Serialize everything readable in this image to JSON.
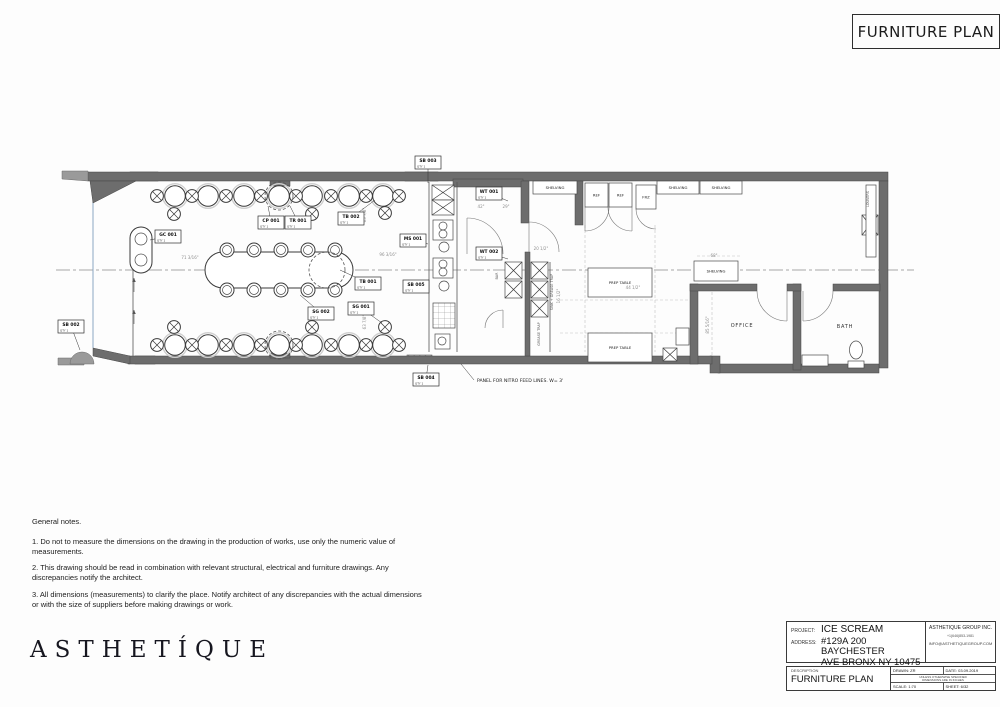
{
  "sheet_title": "FURNITURE PLAN",
  "logo_text": "ASTHETÍQUE",
  "notes": {
    "heading": "General notes.",
    "items": [
      "1. Do not to measure the dimensions on the drawing in the production of works, use only the numeric value of measurements.",
      "2. This drawing should be read in combination with relevant structural, electrical and furniture drawings. Any discrepancies notify the architect.",
      "3. All dimensions (measurements) to clarify the place. Notify architect of any discrepancies with the actual dimensions or with the size of suppliers before making drawings or work."
    ]
  },
  "title_block": {
    "project_label": "PROJECT:",
    "project": "ICE SCREAM",
    "address_label": "ADDRESS:",
    "address_line1": "#129A 200 BAYCHESTER",
    "address_line2": "AVE BRONX NY 10475",
    "company": "ASTHETIQUE GROUP INC.",
    "phone": "+1(646)853-1981",
    "email": "INFO@ASTHETIQUEGROUP.COM",
    "description_label": "DESCRIPTION",
    "description": "FURNITURE PLAN",
    "drawn": "DRAWN: ZR",
    "date": "DATE: 03.09.2019",
    "disclaimer_line1": "UNLESS OTHERWISE SPECIFIED",
    "disclaimer_line2": "DIMENSIONS ARE IN INCHES",
    "scale": "SCALE: 1:70",
    "sheet": "SHEET: 6/32"
  },
  "plan": {
    "centerline": [
      56,
      270,
      914,
      270
    ],
    "walls": [
      [
        88,
        172,
        800,
        9
      ],
      [
        879,
        181,
        9,
        187
      ],
      [
        718,
        364,
        161,
        9
      ],
      [
        710,
        356,
        10,
        17
      ],
      [
        128,
        356,
        584,
        8
      ],
      [
        453,
        179,
        70,
        8
      ],
      [
        521,
        181,
        8,
        42
      ],
      [
        575,
        181,
        8,
        44
      ],
      [
        690,
        284,
        8,
        80
      ],
      [
        793,
        284,
        8,
        86
      ],
      [
        690,
        284,
        67,
        7
      ],
      [
        787,
        284,
        14,
        7
      ],
      [
        833,
        284,
        47,
        7
      ],
      [
        270,
        181,
        20,
        5
      ],
      [
        270,
        353,
        20,
        5
      ],
      [
        525,
        252,
        5,
        104
      ]
    ],
    "hatch": [
      [
        130,
        172,
        28,
        9
      ],
      [
        405,
        172,
        33,
        9
      ],
      [
        135,
        356,
        20,
        8
      ],
      [
        407,
        355,
        25,
        8
      ],
      [
        692,
        285,
        36,
        5
      ],
      [
        691,
        300,
        6,
        36
      ]
    ],
    "polys": [
      {
        "pts": "90,181 136,181 93,203",
        "cls": "wall"
      },
      {
        "pts": "93,348 130,356 130,364 93,356",
        "cls": "wall"
      },
      {
        "pts": "62,171 88,171 88,181 62,179",
        "cls": "lite"
      },
      {
        "pts": "58,358 84,358 84,365 58,365",
        "cls": "lite"
      }
    ],
    "paths": [
      {
        "d": "M70,364 A12,12 0 0 1 94,364 Z",
        "cls": "lite"
      },
      {
        "d": "M529,222 A30,30 0 0 1 559,252",
        "cls": "arc"
      },
      {
        "d": "M529,222 L529,252",
        "cls": "arc"
      },
      {
        "d": "M467,218 A36,36 0 0 1 503,254",
        "cls": "arc"
      },
      {
        "d": "M467,218 L467,254",
        "cls": "arc"
      },
      {
        "d": "M485,328 A18,18 0 0 1 503,310",
        "cls": "arc"
      },
      {
        "d": "M503,310 L503,328",
        "cls": "arc"
      },
      {
        "d": "M757,291 A30,30 0 0 0 787,321",
        "cls": "arc"
      },
      {
        "d": "M787,291 L787,321",
        "cls": "arc"
      },
      {
        "d": "M833,291 A30,30 0 0 1 803,321",
        "cls": "arc"
      },
      {
        "d": "M803,291 L803,321",
        "cls": "arc"
      },
      {
        "d": "M609,207 A24,24 0 0 1 585,231",
        "cls": "arc"
      },
      {
        "d": "M585,207 L585,231",
        "cls": "arc"
      },
      {
        "d": "M608,207 A24,24 0 0 0 632,231",
        "cls": "arc"
      },
      {
        "d": "M632,207 L632,231",
        "cls": "arc"
      },
      {
        "d": "M636,209 A20,20 0 0 0 656,229",
        "cls": "arc"
      }
    ],
    "glass": [
      [
        93,
        181,
        93,
        348
      ]
    ],
    "lines": [
      [
        133,
        268,
        133,
        356
      ],
      [
        457,
        182,
        457,
        352
      ],
      [
        429,
        182,
        429,
        352
      ],
      [
        550,
        262,
        550,
        352
      ]
    ],
    "dashes": [
      [
        585,
        225,
        585,
        352
      ],
      [
        655,
        225,
        655,
        352
      ],
      [
        560,
        300,
        688,
        300
      ],
      [
        560,
        333,
        688,
        333
      ],
      [
        697,
        256,
        740,
        256
      ],
      [
        712,
        292,
        712,
        360
      ]
    ],
    "tables_top_y": 196,
    "tables_bottom_y": 345,
    "tables_x": [
      175,
      208,
      244,
      279,
      312,
      349,
      383
    ],
    "chairs": [
      [
        157,
        196
      ],
      [
        192,
        196
      ],
      [
        226,
        196
      ],
      [
        261,
        196
      ],
      [
        296,
        196
      ],
      [
        331,
        196
      ],
      [
        366,
        196
      ],
      [
        399,
        196
      ],
      [
        174,
        214
      ],
      [
        312,
        214
      ],
      [
        385,
        213
      ],
      [
        157,
        345
      ],
      [
        192,
        345
      ],
      [
        226,
        345
      ],
      [
        261,
        345
      ],
      [
        296,
        345
      ],
      [
        331,
        345
      ],
      [
        366,
        345
      ],
      [
        399,
        345
      ],
      [
        174,
        327
      ],
      [
        312,
        327
      ],
      [
        385,
        327
      ]
    ],
    "stools": [
      [
        227,
        250
      ],
      [
        254,
        250
      ],
      [
        281,
        250
      ],
      [
        308,
        250
      ],
      [
        335,
        250
      ],
      [
        227,
        290
      ],
      [
        254,
        290
      ],
      [
        281,
        290
      ],
      [
        308,
        290
      ],
      [
        335,
        290
      ]
    ],
    "rings": [
      [
        279,
        196,
        14
      ],
      [
        279,
        345,
        14
      ],
      [
        327,
        270,
        18
      ]
    ],
    "oval": {
      "x": 205,
      "y": 252,
      "w": 148,
      "h": 36,
      "rx": 18
    },
    "pill": {
      "x": 130,
      "y": 227,
      "w": 22,
      "h": 46,
      "rx": 11,
      "c1": [
        141,
        239
      ],
      "c2": [
        141,
        260
      ],
      "r": 6
    },
    "xboxes": [
      [
        432,
        185,
        22,
        15
      ],
      [
        432,
        200,
        22,
        15
      ],
      [
        531,
        262,
        17,
        17
      ],
      [
        531,
        281,
        17,
        17
      ],
      [
        531,
        300,
        17,
        17
      ],
      [
        505,
        262,
        17,
        17
      ],
      [
        505,
        281,
        17,
        17
      ],
      [
        862,
        215,
        16,
        20
      ],
      [
        663,
        348,
        14,
        13
      ]
    ],
    "equip_rects": [
      [
        433,
        220,
        20,
        20
      ],
      [
        433,
        258,
        20,
        20
      ],
      [
        435,
        334,
        15,
        15
      ]
    ],
    "equip_circles": [
      [
        443,
        226,
        4
      ],
      [
        443,
        234,
        4
      ],
      [
        443,
        264,
        4
      ],
      [
        443,
        272,
        4
      ],
      [
        444,
        247,
        5
      ],
      [
        444,
        286,
        5
      ],
      [
        442,
        341,
        4
      ],
      [
        815,
        360,
        3.5
      ]
    ],
    "gridbox": [
      433,
      303,
      22,
      25
    ],
    "boxes": [
      {
        "x": 533,
        "y": 181,
        "w": 44,
        "h": 13,
        "t": "SHELVING"
      },
      {
        "x": 657,
        "y": 181,
        "w": 42,
        "h": 13,
        "t": "SHELVING"
      },
      {
        "x": 700,
        "y": 181,
        "w": 42,
        "h": 13,
        "t": "SHELVING"
      },
      {
        "x": 694,
        "y": 261,
        "w": 44,
        "h": 20,
        "t": "SHELVING"
      },
      {
        "x": 585,
        "y": 183,
        "w": 23,
        "h": 24,
        "t": "REF"
      },
      {
        "x": 609,
        "y": 183,
        "w": 23,
        "h": 24,
        "t": "REF"
      },
      {
        "x": 636,
        "y": 185,
        "w": 20,
        "h": 24,
        "t": "FRZ"
      },
      {
        "x": 588,
        "y": 268,
        "w": 64,
        "h": 29,
        "t": "PREP TABLE"
      },
      {
        "x": 588,
        "y": 333,
        "w": 64,
        "h": 29,
        "t": "PREP TABLE"
      },
      {
        "x": 866,
        "y": 185,
        "w": 10,
        "h": 72,
        "t": ""
      },
      {
        "x": 676,
        "y": 328,
        "w": 13,
        "h": 17,
        "t": ""
      },
      {
        "x": 802,
        "y": 355,
        "w": 26,
        "h": 11,
        "t": ""
      }
    ],
    "toilet": {
      "cx": 856,
      "cy": 350,
      "rx": 6.5,
      "ry": 9,
      "tank": [
        848,
        361,
        16,
        7
      ]
    },
    "tags": [
      {
        "c": "SB 003",
        "q": "QTY 1",
        "x": 415,
        "y": 156,
        "tx": 428,
        "ty": 183
      },
      {
        "c": "WT 001",
        "q": "QTY 1",
        "x": 476,
        "y": 187,
        "tx": 508,
        "ty": 201
      },
      {
        "c": "MS 001",
        "q": "QTY 1",
        "x": 400,
        "y": 234,
        "tx": 428,
        "ty": 244
      },
      {
        "c": "WT 002",
        "q": "QTY 1",
        "x": 476,
        "y": 247,
        "tx": 508,
        "ty": 259
      },
      {
        "c": "SB 005",
        "q": "QTY 1",
        "x": 403,
        "y": 280,
        "tx": 428,
        "ty": 289
      },
      {
        "c": "SB 004",
        "q": "QTY 1",
        "x": 413,
        "y": 373,
        "tx": 428,
        "ty": 365
      },
      {
        "c": "SB 002",
        "q": "QTY 1",
        "x": 58,
        "y": 320,
        "tx": 80,
        "ty": 350
      },
      {
        "c": "GC 001",
        "q": "QTY 1",
        "x": 155,
        "y": 230,
        "tx": 150,
        "ty": 240
      },
      {
        "c": "CP 001",
        "q": "QTY 1",
        "x": 258,
        "y": 216,
        "tx": 268,
        "ty": 206
      },
      {
        "c": "TR 001",
        "q": "QTY 1",
        "x": 285,
        "y": 216,
        "tx": 290,
        "ty": 206
      },
      {
        "c": "TB 002",
        "q": "QTY 1",
        "x": 338,
        "y": 212,
        "tx": 375,
        "ty": 200
      },
      {
        "c": "TB 001",
        "q": "QTY 1",
        "x": 355,
        "y": 277,
        "tx": 340,
        "ty": 270
      },
      {
        "c": "SG 002",
        "q": "QTY 1",
        "x": 308,
        "y": 307,
        "tx": 300,
        "ty": 295
      },
      {
        "c": "SG 001",
        "q": "QTY 1",
        "x": 348,
        "y": 302,
        "tx": 382,
        "ty": 323
      }
    ],
    "rooms": [
      {
        "t": "OFFICE",
        "x": 742,
        "y": 327
      },
      {
        "t": "BATH",
        "x": 845,
        "y": 328
      }
    ],
    "vtexts": [
      {
        "t": "SINK + GREASE TRAP",
        "x": 553,
        "y": 292
      },
      {
        "t": "GREASE TRAP",
        "x": 540,
        "y": 334
      },
      {
        "t": "BAR",
        "x": 498,
        "y": 276
      },
      {
        "t": "LOUVERS",
        "x": 869,
        "y": 199
      }
    ],
    "dims": [
      {
        "t": "71 3/16\"",
        "x": 190,
        "y": 259
      },
      {
        "t": "96 3/16\"",
        "x": 388,
        "y": 256
      },
      {
        "t": "63 7/8\"",
        "x": 366,
        "y": 215,
        "v": true
      },
      {
        "t": "63 7/8\"",
        "x": 366,
        "y": 322,
        "v": true
      },
      {
        "t": "44 1/2\"",
        "x": 633,
        "y": 289
      },
      {
        "t": "20 1/2\"",
        "x": 541,
        "y": 250
      },
      {
        "t": "68\"",
        "x": 714,
        "y": 257
      },
      {
        "t": "42\"",
        "x": 481,
        "y": 208
      },
      {
        "t": "29\"",
        "x": 506,
        "y": 208
      },
      {
        "t": "85 5/16\"",
        "x": 709,
        "y": 325,
        "v": true
      },
      {
        "t": "16 1/2\"",
        "x": 560,
        "y": 296,
        "v": true
      }
    ],
    "annotation": {
      "t": "PANEL FOR NITRO FEED LINES. W= 3'",
      "x": 477,
      "y": 382,
      "leader": "M474,380 L461,364"
    },
    "arrows": [
      [
        134,
        292,
        134,
        278
      ],
      [
        134,
        324,
        134,
        310
      ]
    ]
  }
}
